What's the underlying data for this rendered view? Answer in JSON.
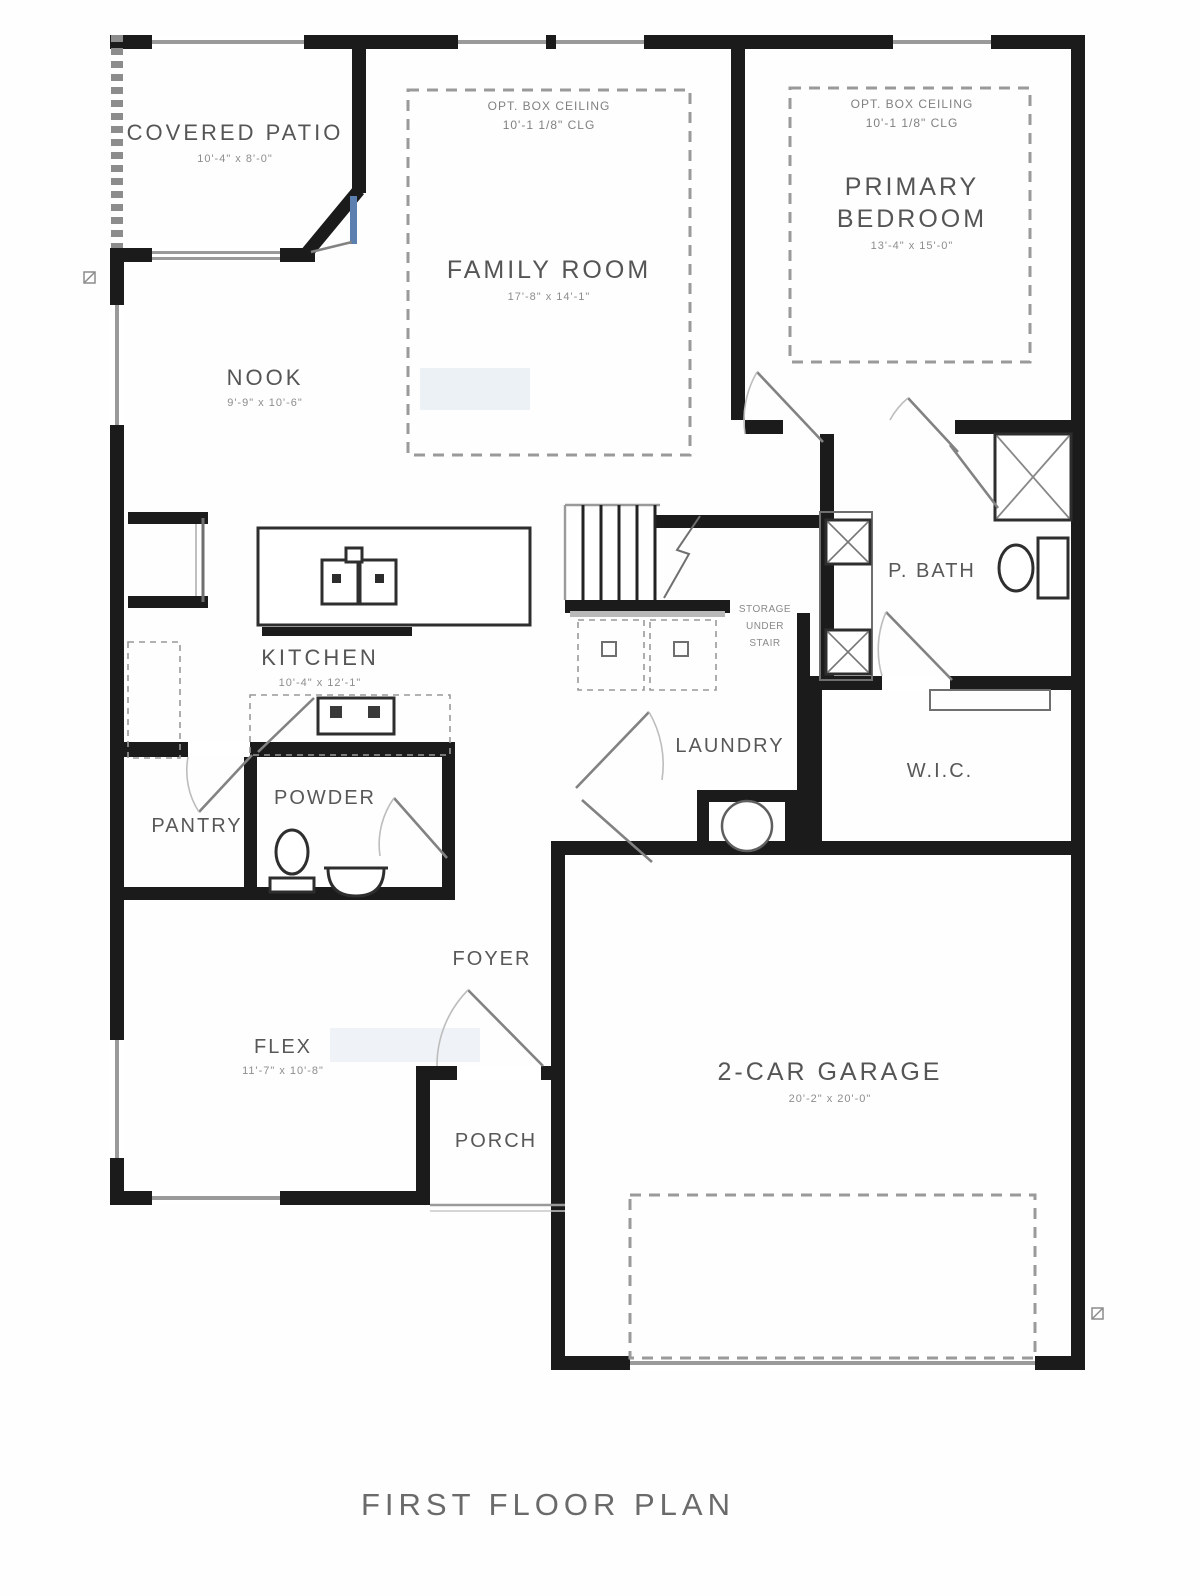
{
  "title": "FIRST FLOOR PLAN",
  "rooms": {
    "covered_patio": {
      "name": "COVERED PATIO",
      "dim": "10'-4\" x 8'-0\""
    },
    "family_room": {
      "name": "FAMILY ROOM",
      "dim": "17'-8\" x 14'-1\"",
      "ceiling_note_1": "OPT. BOX CEILING",
      "ceiling_note_2": "10'-1 1/8\" CLG"
    },
    "primary_bedroom": {
      "name_line1": "PRIMARY",
      "name_line2": "BEDROOM",
      "dim": "13'-4\" x 15'-0\"",
      "ceiling_note_1": "OPT. BOX CEILING",
      "ceiling_note_2": "10'-1 1/8\" CLG"
    },
    "nook": {
      "name": "NOOK",
      "dim": "9'-9\" x 10'-6\""
    },
    "kitchen": {
      "name": "KITCHEN",
      "dim": "10'-4\" x 12'-1\""
    },
    "pantry": {
      "name": "PANTRY"
    },
    "powder": {
      "name": "POWDER"
    },
    "laundry": {
      "name": "LAUNDRY"
    },
    "p_bath": {
      "name": "P. BATH"
    },
    "wic": {
      "name": "W.I.C."
    },
    "storage_note": {
      "line1": "STORAGE",
      "line2": "UNDER",
      "line3": "STAIR"
    },
    "foyer": {
      "name": "FOYER"
    },
    "flex": {
      "name": "FLEX",
      "dim": "11'-7\" x 10'-8\""
    },
    "porch": {
      "name": "PORCH"
    },
    "garage": {
      "name": "2-CAR GARAGE",
      "dim": "20'-2\" x 20'-0\""
    }
  }
}
